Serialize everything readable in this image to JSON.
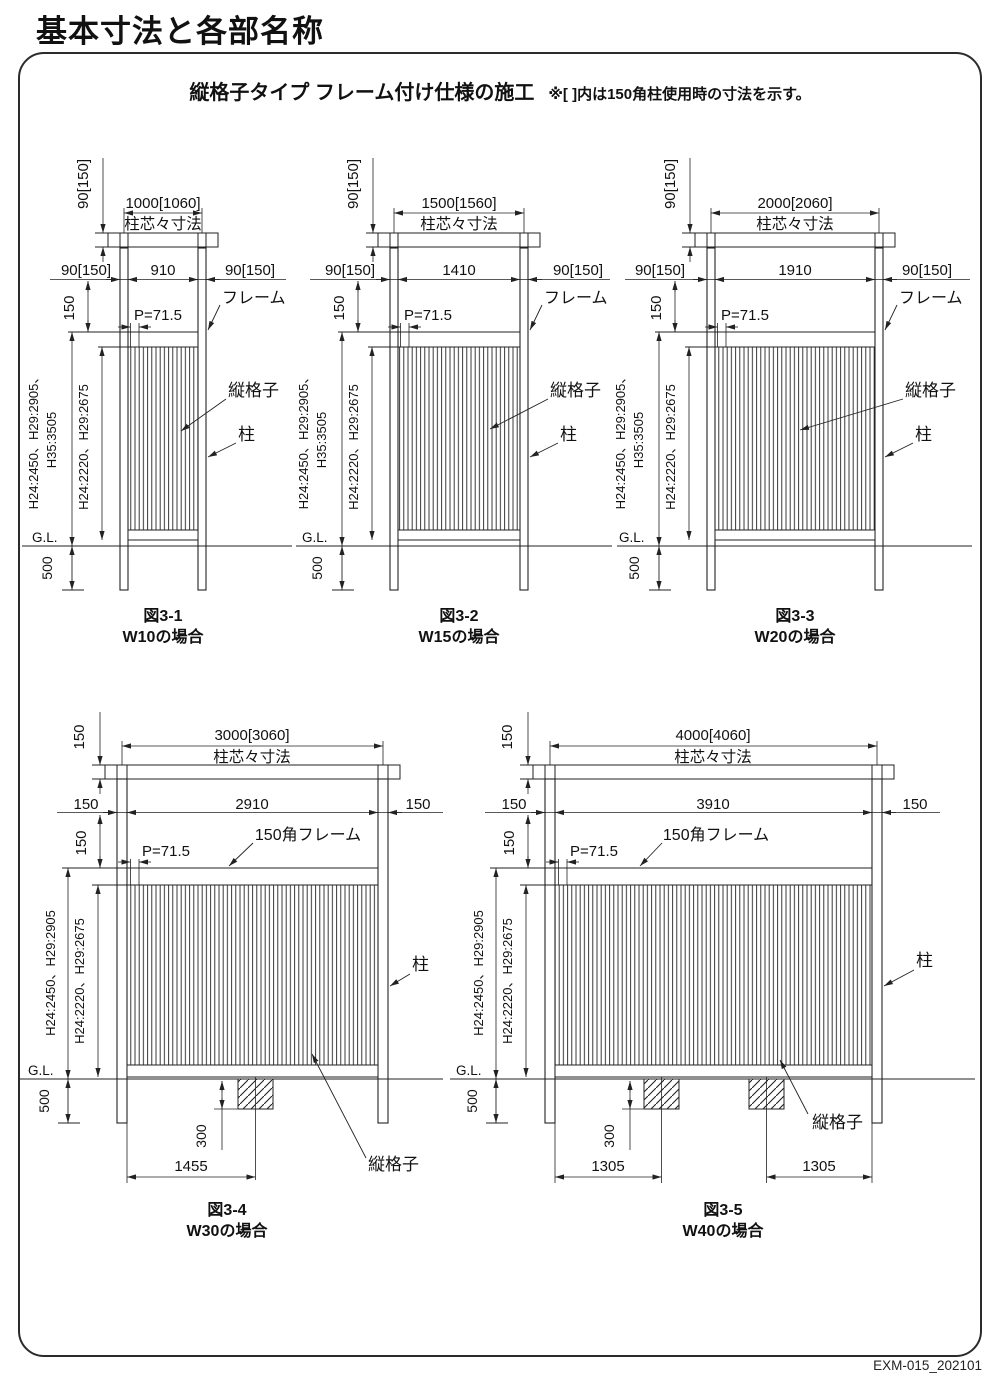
{
  "page": {
    "title": "基本寸法と各部名称",
    "footer": "EXM-015_202101"
  },
  "header": {
    "main": "縦格子タイプ フレーム付け仕様の施工",
    "note": "※[ ]内は150角柱使用時の寸法を示す。"
  },
  "common": {
    "cc_label": "柱芯々寸法",
    "pitch": "P=71.5",
    "frame_label": "フレーム",
    "frame150_label": "150角フレーム",
    "lattice_label": "縦格子",
    "post_label": "柱",
    "gl": "G.L.",
    "d500": "500",
    "d150": "150",
    "d300": "300",
    "h_outer_l1": "H24:2450、H29:2905、",
    "h_outer_l2": "H35:3505",
    "h_outer": "H24:2450、H29:2905",
    "h_inner": "H24:2220、H29:2675"
  },
  "figures": {
    "f1": {
      "caption": "図3-1",
      "case": "W10の場合",
      "total": "1000[1060]",
      "span": "910",
      "side": "90[150]",
      "bar": "90[150]"
    },
    "f2": {
      "caption": "図3-2",
      "case": "W15の場合",
      "total": "1500[1560]",
      "span": "1410",
      "side": "90[150]",
      "bar": "90[150]"
    },
    "f3": {
      "caption": "図3-3",
      "case": "W20の場合",
      "total": "2000[2060]",
      "span": "1910",
      "side": "90[150]",
      "bar": "90[150]"
    },
    "f4": {
      "caption": "図3-4",
      "case": "W30の場合",
      "total": "3000[3060]",
      "span": "2910",
      "side": "150",
      "bar": "150",
      "block_depth": "300",
      "span1": "1455"
    },
    "f5": {
      "caption": "図3-5",
      "case": "W40の場合",
      "total": "4000[4060]",
      "span": "3910",
      "side": "150",
      "bar": "150",
      "block_depth": "300",
      "span1": "1305",
      "span2": "1305"
    }
  }
}
